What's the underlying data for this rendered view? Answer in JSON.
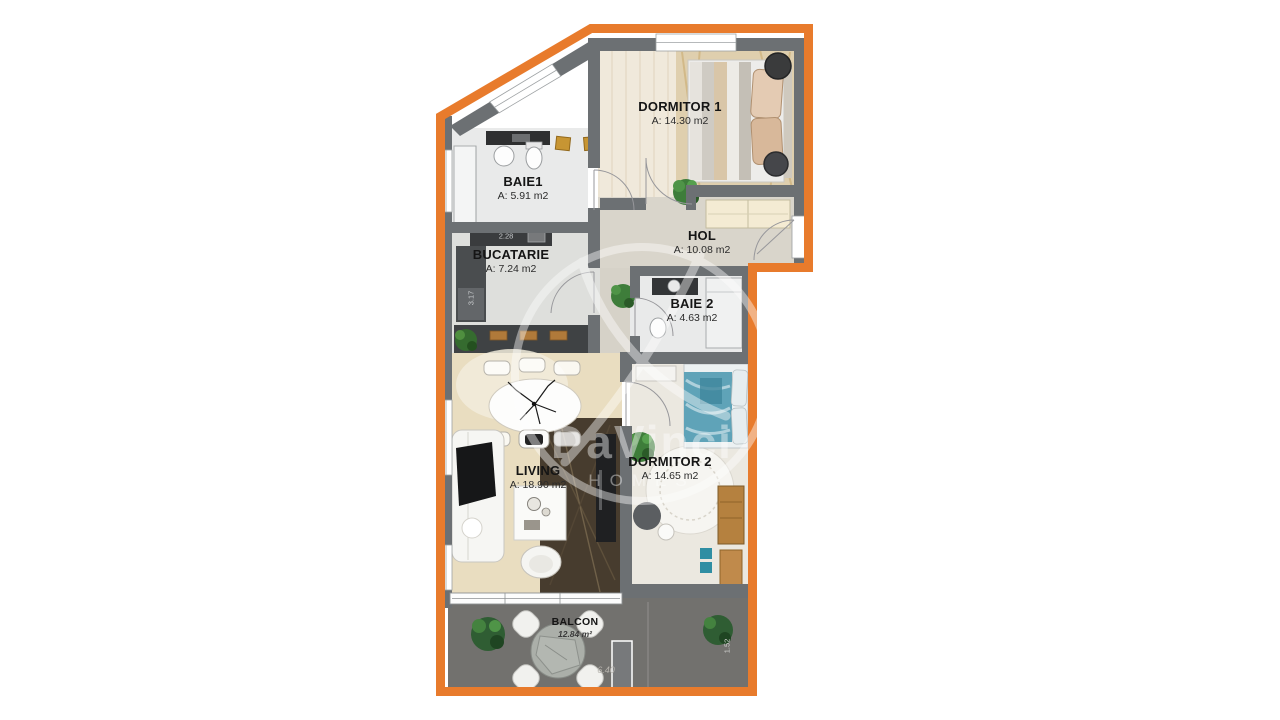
{
  "watermark": {
    "line1": "DaVinci",
    "line2": "HOMES"
  },
  "rooms": [
    {
      "id": "dormitor-1",
      "name": "DORMITOR 1",
      "area": "A: 14.30 m2"
    },
    {
      "id": "baie-1",
      "name": "BAIE1",
      "area": "A: 5.91 m2"
    },
    {
      "id": "bucatarie",
      "name": "BUCATARIE",
      "area": "A: 7.24 m2"
    },
    {
      "id": "hol",
      "name": "HOL",
      "area": "A: 10.08 m2"
    },
    {
      "id": "baie-2",
      "name": "BAIE 2",
      "area": "A: 4.63 m2"
    },
    {
      "id": "living",
      "name": "LIVING",
      "area": "A: 18.90 m2"
    },
    {
      "id": "dormitor-2",
      "name": "DORMITOR 2",
      "area": "A: 14.65 m2"
    },
    {
      "id": "balcon",
      "name": "BALCON",
      "area": "12.84 m²"
    }
  ],
  "dimensions": [
    {
      "id": "kitchen-width",
      "label": "2.28"
    },
    {
      "id": "kitchen-depth",
      "label": "3.17"
    },
    {
      "id": "balcony-width",
      "label": "6.40"
    },
    {
      "id": "balcony-depth",
      "label": "1.52"
    }
  ],
  "colors": {
    "outline": "#E87B2C",
    "wall": "#6C7073",
    "balcony_floor": "#72716E"
  }
}
